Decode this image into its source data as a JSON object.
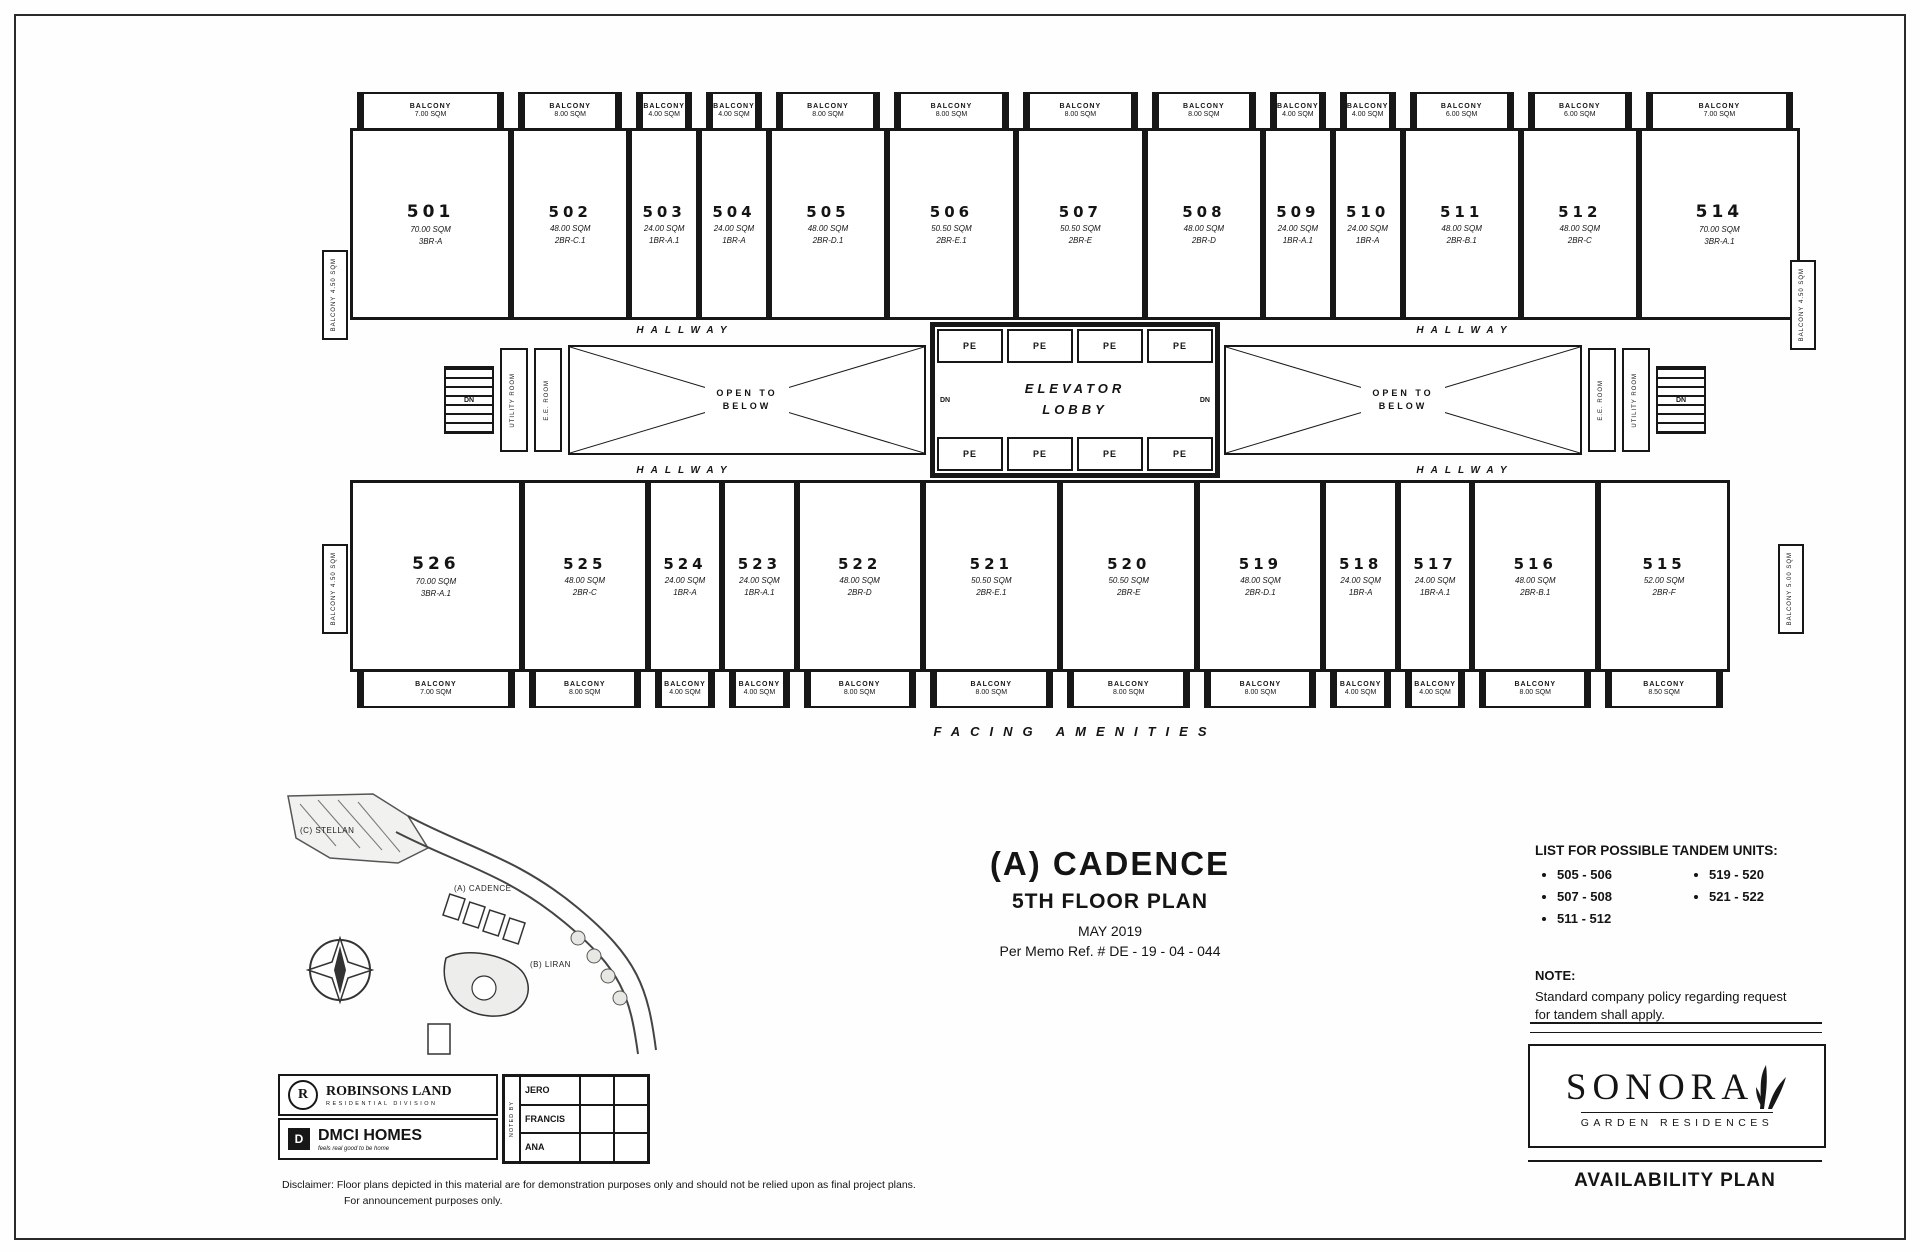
{
  "sheet": {
    "availability": "AVAILABILITY PLAN",
    "disclaimer_line1": "Disclaimer: Floor plans depicted in this material are for demonstration purposes only and should not be relied upon as final project plans.",
    "disclaimer_line2": "For announcement purposes only."
  },
  "title_block": {
    "building": "(A) CADENCE",
    "floor": "5TH FLOOR PLAN",
    "date": "MAY 2019",
    "memo": "Per Memo Ref. # DE - 19 - 04 - 044"
  },
  "tandem": {
    "heading": "LIST FOR POSSIBLE TANDEM UNITS:",
    "col1": [
      "505 - 506",
      "507 - 508",
      "511 - 512"
    ],
    "col2": [
      "519 - 520",
      "521 - 522"
    ]
  },
  "note": {
    "heading": "NOTE:",
    "text": "Standard company policy regarding request for tandem shall apply."
  },
  "branding": {
    "rl_monogram": "R",
    "rl_name": "ROBINSONS LAND",
    "rl_sub": "RESIDENTIAL DIVISION",
    "dm_monogram": "D",
    "dm_name": "DMCI HOMES",
    "dm_sub": "feels real good to be home",
    "noted_by": "NOTED BY",
    "signatories": [
      "JERO",
      "FRANCIS",
      "ANA"
    ],
    "sonora": "SONORA",
    "sonora_sub": "GARDEN RESIDENCES"
  },
  "site_map": {
    "label_stellan": "(C) STELLAN",
    "label_cadence": "(A) CADENCE",
    "label_liran": "(B) LIRAN"
  },
  "plan": {
    "hallway": "HALLWAY",
    "open_below": "OPEN TO BELOW",
    "elevator_lobby": "ELEVATOR LOBBY",
    "pe": "PE",
    "dn": "DN",
    "utility_room": "UTILITY ROOM",
    "ee_room": "E.E. ROOM",
    "balcony_word": "BALCONY",
    "facing": "FACING AMENITIES",
    "top_units": [
      {
        "number": "501",
        "area": "70.00 SQM",
        "type": "3BR-A",
        "balcony": "7.00 SQM"
      },
      {
        "number": "502",
        "area": "48.00 SQM",
        "type": "2BR-C.1",
        "balcony": "8.00 SQM"
      },
      {
        "number": "503",
        "area": "24.00 SQM",
        "type": "1BR-A.1",
        "balcony": "4.00 SQM"
      },
      {
        "number": "504",
        "area": "24.00 SQM",
        "type": "1BR-A",
        "balcony": "4.00 SQM"
      },
      {
        "number": "505",
        "area": "48.00 SQM",
        "type": "2BR-D.1",
        "balcony": "8.00 SQM"
      },
      {
        "number": "506",
        "area": "50.50 SQM",
        "type": "2BR-E.1",
        "balcony": "8.00 SQM"
      },
      {
        "number": "507",
        "area": "50.50 SQM",
        "type": "2BR-E",
        "balcony": "8.00 SQM"
      },
      {
        "number": "508",
        "area": "48.00 SQM",
        "type": "2BR-D",
        "balcony": "8.00 SQM"
      },
      {
        "number": "509",
        "area": "24.00 SQM",
        "type": "1BR-A.1",
        "balcony": "4.00 SQM"
      },
      {
        "number": "510",
        "area": "24.00 SQM",
        "type": "1BR-A",
        "balcony": "4.00 SQM"
      },
      {
        "number": "511",
        "area": "48.00 SQM",
        "type": "2BR-B.1",
        "balcony": "6.00 SQM"
      },
      {
        "number": "512",
        "area": "48.00 SQM",
        "type": "2BR-C",
        "balcony": "6.00 SQM"
      },
      {
        "number": "514",
        "area": "70.00 SQM",
        "type": "3BR-A.1",
        "balcony": "7.00 SQM"
      }
    ],
    "bottom_units": [
      {
        "number": "526",
        "area": "70.00 SQM",
        "type": "3BR-A.1",
        "balcony": "7.00 SQM"
      },
      {
        "number": "525",
        "area": "48.00 SQM",
        "type": "2BR-C",
        "balcony": "8.00 SQM"
      },
      {
        "number": "524",
        "area": "24.00 SQM",
        "type": "1BR-A",
        "balcony": "4.00 SQM"
      },
      {
        "number": "523",
        "area": "24.00 SQM",
        "type": "1BR-A.1",
        "balcony": "4.00 SQM"
      },
      {
        "number": "522",
        "area": "48.00 SQM",
        "type": "2BR-D",
        "balcony": "8.00 SQM"
      },
      {
        "number": "521",
        "area": "50.50 SQM",
        "type": "2BR-E.1",
        "balcony": "8.00 SQM"
      },
      {
        "number": "520",
        "area": "50.50 SQM",
        "type": "2BR-E",
        "balcony": "8.00 SQM"
      },
      {
        "number": "519",
        "area": "48.00 SQM",
        "type": "2BR-D.1",
        "balcony": "8.00 SQM"
      },
      {
        "number": "518",
        "area": "24.00 SQM",
        "type": "1BR-A",
        "balcony": "4.00 SQM"
      },
      {
        "number": "517",
        "area": "24.00 SQM",
        "type": "1BR-A.1",
        "balcony": "4.00 SQM"
      },
      {
        "number": "516",
        "area": "48.00 SQM",
        "type": "2BR-B.1",
        "balcony": "8.00 SQM"
      },
      {
        "number": "515",
        "area": "52.00 SQM",
        "type": "2BR-F",
        "balcony": "8.50 SQM"
      }
    ],
    "side_balconies": [
      {
        "area": "4.50 SQM"
      },
      {
        "area": "4.50 SQM"
      },
      {
        "area": "4.50 SQM"
      },
      {
        "area": "5.00 SQM"
      }
    ]
  }
}
